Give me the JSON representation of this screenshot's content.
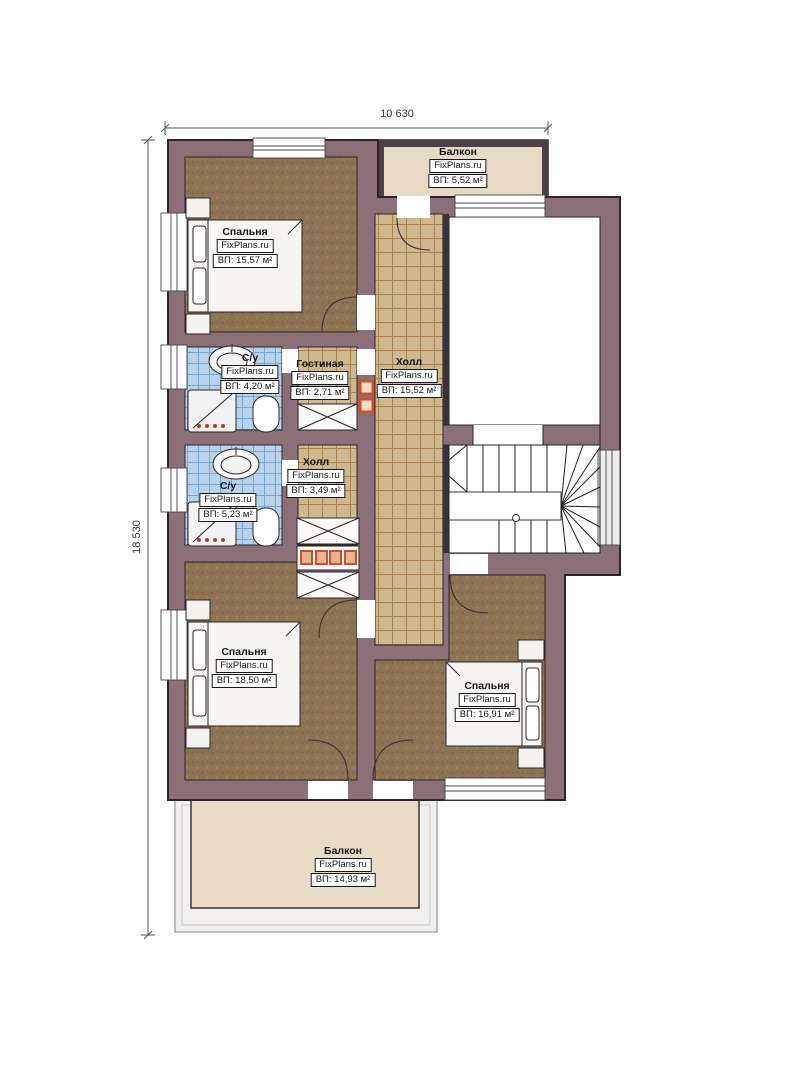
{
  "dimensions": {
    "width_label": "10 630",
    "height_label": "18 530"
  },
  "watermark": "FixPlans.ru",
  "rooms": [
    {
      "id": "balcony-top",
      "name": "Балкон",
      "area": "ВП: 5,52 м²"
    },
    {
      "id": "bedroom-top",
      "name": "Спальня",
      "area": "ВП: 15,57 м²"
    },
    {
      "id": "bathroom-top",
      "name": "С/у",
      "area": "ВП: 4,20 м²"
    },
    {
      "id": "living-room",
      "name": "Гостиная",
      "area": "ВП: 2,71 м²"
    },
    {
      "id": "hall-main",
      "name": "Холл",
      "area": "ВП: 15,52 м²"
    },
    {
      "id": "bathroom-bottom",
      "name": "С/у",
      "area": "ВП: 5,23 м²"
    },
    {
      "id": "hall-small",
      "name": "Холл",
      "area": "ВП: 3,49 м²"
    },
    {
      "id": "bedroom-bottom-left",
      "name": "Спальня",
      "area": "ВП: 18,50 м²"
    },
    {
      "id": "bedroom-bottom-right",
      "name": "Спальня",
      "area": "ВП: 16,91 м²"
    },
    {
      "id": "balcony-bottom",
      "name": "Балкон",
      "area": "ВП: 14,93 м²"
    }
  ],
  "colors": {
    "wall_fill": "#8b7177",
    "wall_outline": "#2e2429",
    "tile_beige": "#cdb890",
    "tile_blue": "#b7d3ec",
    "carpet_brown": "#8c7353",
    "balcony_beige": "#e6dac5",
    "accent_orange": "#c8502f"
  }
}
